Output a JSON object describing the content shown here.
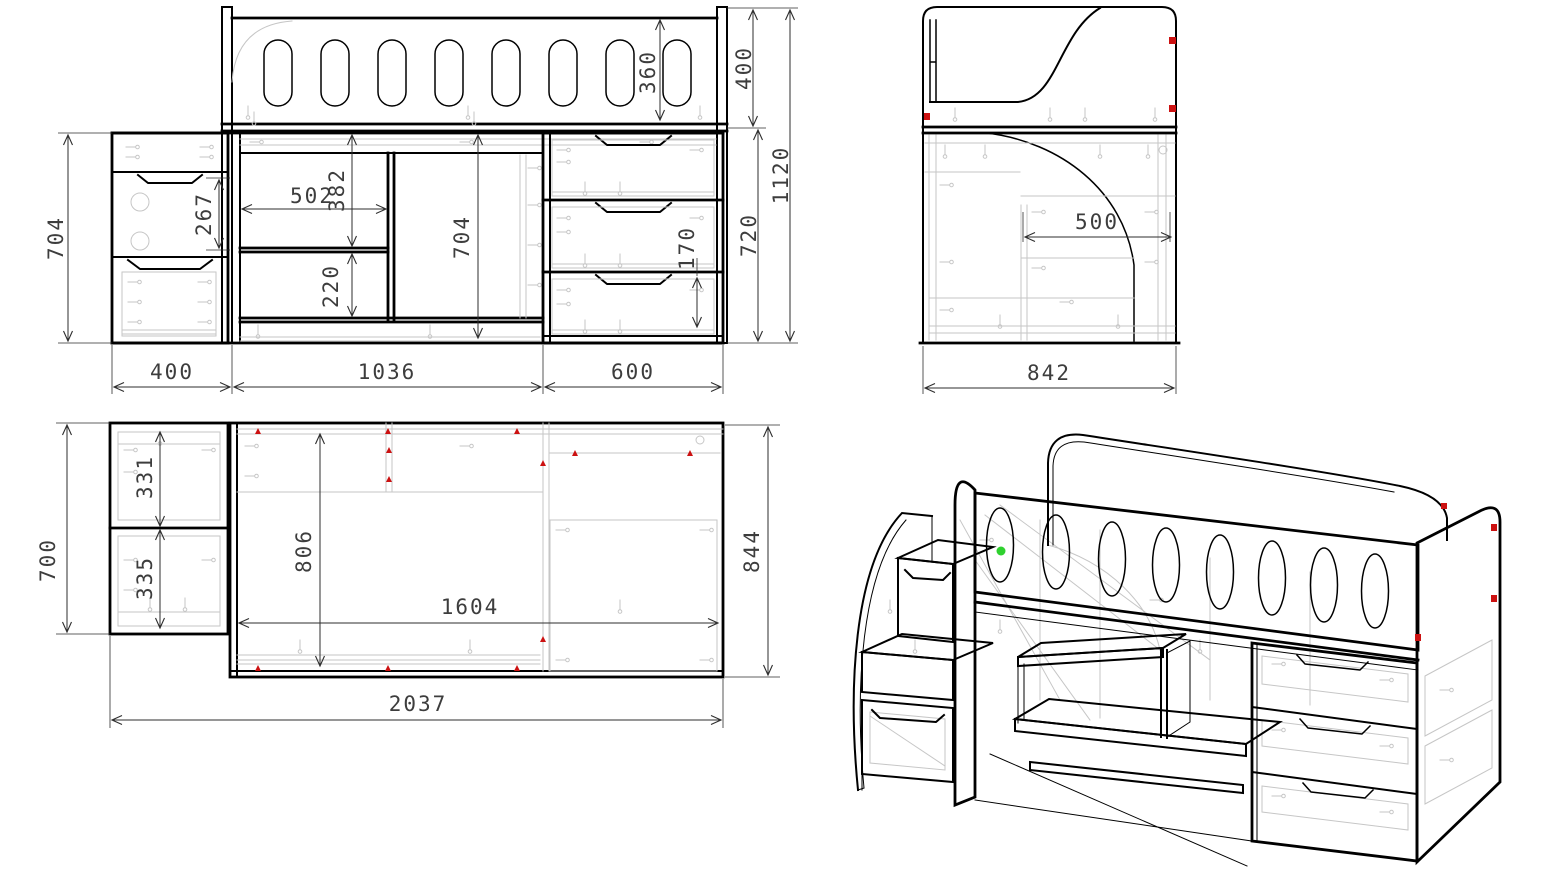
{
  "drawing": {
    "front": {
      "rail_oval_height": "360",
      "upper_section_height": "400",
      "overall_height": "1120",
      "lower_cabinet_height": "720",
      "drawer_inner_height": "170",
      "left_cabinet_height": "704",
      "left_drawer_height": "267",
      "desk_opening_width": "502",
      "desk_upper_height": "382",
      "desk_lower_height": "220",
      "center_opening_height": "704",
      "width_left": "400",
      "width_center": "1036",
      "width_right": "600"
    },
    "side": {
      "overall_depth": "842",
      "desk_depth": "500"
    },
    "plan": {
      "left_module_depth": "700",
      "left_module_top": "331",
      "left_module_bottom": "335",
      "inner_depth": "806",
      "inner_width": "1604",
      "body_depth": "844",
      "total_width": "2037"
    },
    "colors": {
      "line": "#000000",
      "faint_construction": "#c6c6c6",
      "dimension_text": "#3d3d3d",
      "marker_red": "#cc1111",
      "marker_green": "#2fd12f",
      "background": "#ffffff"
    }
  }
}
